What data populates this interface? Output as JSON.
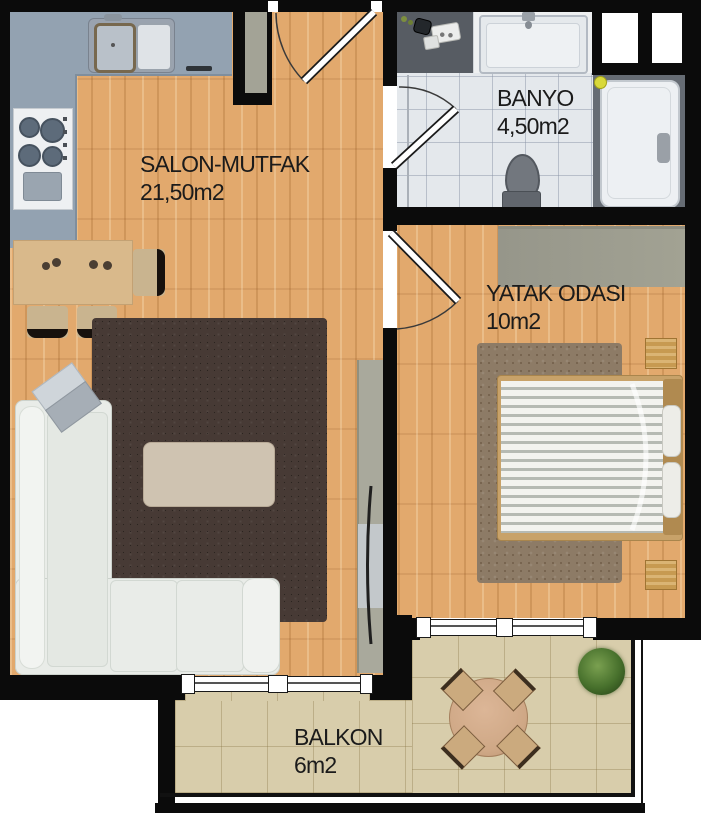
{
  "plan": {
    "rooms": [
      {
        "id": "salon-mutfak",
        "label": "SALON-MUTFAK",
        "area": "21,50m2"
      },
      {
        "id": "banyo",
        "label": "BANYO",
        "area": "4,50m2"
      },
      {
        "id": "yatak-odasi",
        "label": "YATAK ODASI",
        "area": "10m2"
      },
      {
        "id": "balkon",
        "label": "BALKON",
        "area": "6m2"
      }
    ],
    "colors": {
      "wall": "#0b0b0b",
      "wood_floor": "#e2a96d",
      "bathroom_tile": "#e4e8ec",
      "balcony_tile": "#d8cdab",
      "kitchen_counter": "#93a2b1",
      "bathroom_counter_dark": "#575c63",
      "salon_rug": "#473a35",
      "bedroom_rug": "#8d7b66",
      "sofa": "#e9ece8",
      "wardrobe": "#9d9d8f",
      "bed_frame_wood": "#c8a269",
      "balcony_table_wood": "#cfa886",
      "plant_green": "#47702c",
      "duck_yellow": "#d9d93b",
      "label_text": "#1b1b1b"
    }
  }
}
